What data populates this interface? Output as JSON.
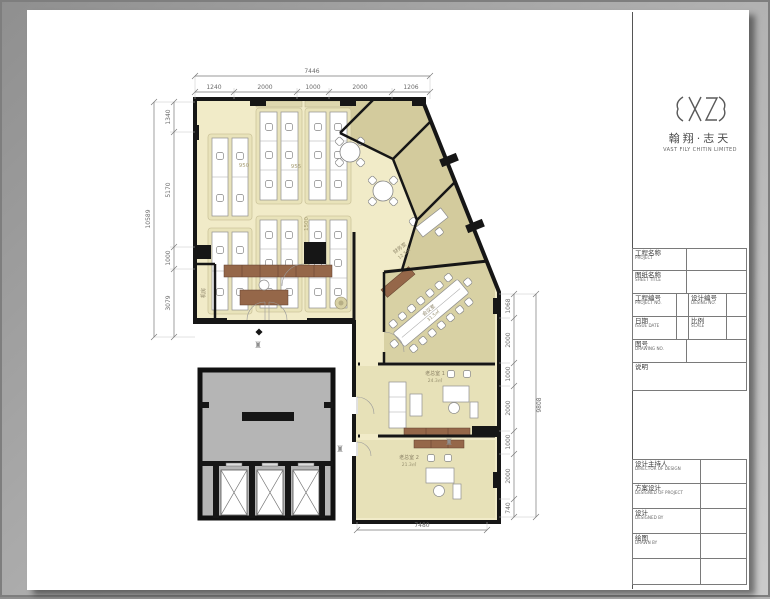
{
  "logo": {
    "mark_icon": "seal-monogram-icon",
    "cn": "翰翔·志天",
    "en": "VAST FILY CHITIN LIMITED"
  },
  "title_block": {
    "upper_rows": [
      {
        "cn": "工程名称",
        "en": "PROJECT"
      },
      {
        "cn": "图纸名称",
        "en": "SHEET TITLE"
      }
    ],
    "pair_rows": [
      [
        {
          "cn": "工程编号",
          "en": "PROJECT NO."
        },
        {
          "cn": "设计编号",
          "en": "DESING NO."
        }
      ],
      [
        {
          "cn": "日期",
          "en": "ISSUE DATE"
        },
        {
          "cn": "比例",
          "en": "SCALE"
        }
      ]
    ],
    "drawing_no": {
      "cn": "图号",
      "en": "DRAWING NO."
    },
    "notes": {
      "cn": "说明"
    },
    "lower_rows": [
      {
        "cn": "设计主持人",
        "en": "DIRECTOR OF DESIGN"
      },
      {
        "cn": "方案设计",
        "en": "DESIGNED OF PROJECT"
      },
      {
        "cn": "设计",
        "en": "DESIGNED BY"
      },
      {
        "cn": "绘图",
        "en": "DRAWN BY"
      }
    ]
  },
  "dims": {
    "top_total": "7446",
    "top_segments": [
      "1240",
      "2000",
      "1000",
      "2000",
      "1206"
    ],
    "left_total": "10589",
    "left_segments": [
      "1340",
      "5170",
      "1000",
      "3079"
    ],
    "right_total": "9808",
    "right_segments": [
      "1068",
      "2000",
      "1000",
      "2000",
      "1000",
      "2000",
      "740"
    ],
    "bottom_total": "7480",
    "inner": {
      "a": "950",
      "b": "955",
      "c": "1500"
    }
  },
  "rooms": {
    "finance": {
      "name": "财务室",
      "area": "12.5㎡"
    },
    "meeting": {
      "name": "会议室",
      "area": "31.5㎡"
    },
    "boss1": {
      "name": "老总室 1",
      "area": "24.3㎡"
    },
    "boss2": {
      "name": "老总室 2",
      "area": "21.3㎡"
    },
    "machine": {
      "name": "机房"
    }
  },
  "markers": {
    "ornament_glyph": "♜"
  },
  "colors": {
    "floor_cream": "#f1ebc8",
    "floor_khaki": "#d3cb9d",
    "floor_exec": "#e7e1b8",
    "wall": "#161616",
    "wood": "#956749",
    "core_gray": "#b5b5b5"
  }
}
